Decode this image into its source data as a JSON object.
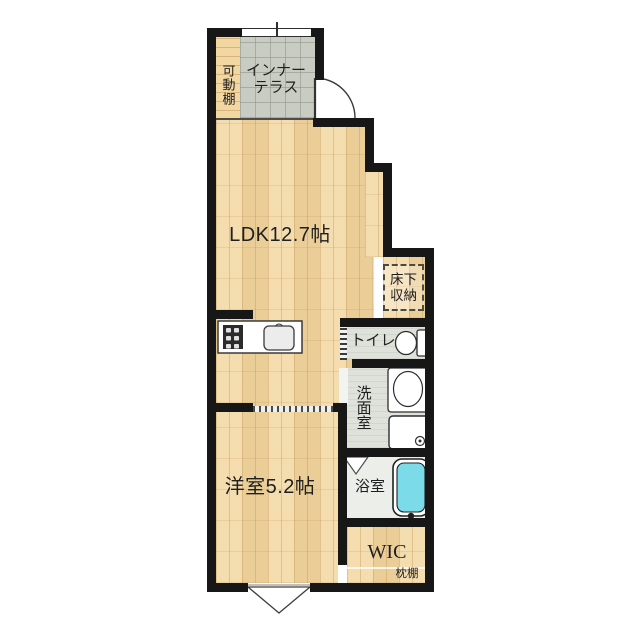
{
  "plan": {
    "movable_shelf": "可動棚",
    "inner_terrace_l1": "インナー",
    "inner_terrace_l2": "テラス",
    "ldk": "LDK12.7帖",
    "underfloor_l1": "床下",
    "underfloor_l2": "収納",
    "toilet": "トイレ",
    "washroom": "洗面室",
    "bathroom": "浴室",
    "bedroom": "洋室5.2帖",
    "wic": "WIC",
    "pillow_shelf": "枕棚"
  },
  "colors": {
    "wall": "#171717",
    "wood": "#f2d7a2",
    "terrace": "#c8ccc3",
    "wet_floor": "#dfe2da",
    "bath_floor": "#eceeea",
    "bathtub": "#7cdbe9",
    "text": "#1f1f1f"
  }
}
